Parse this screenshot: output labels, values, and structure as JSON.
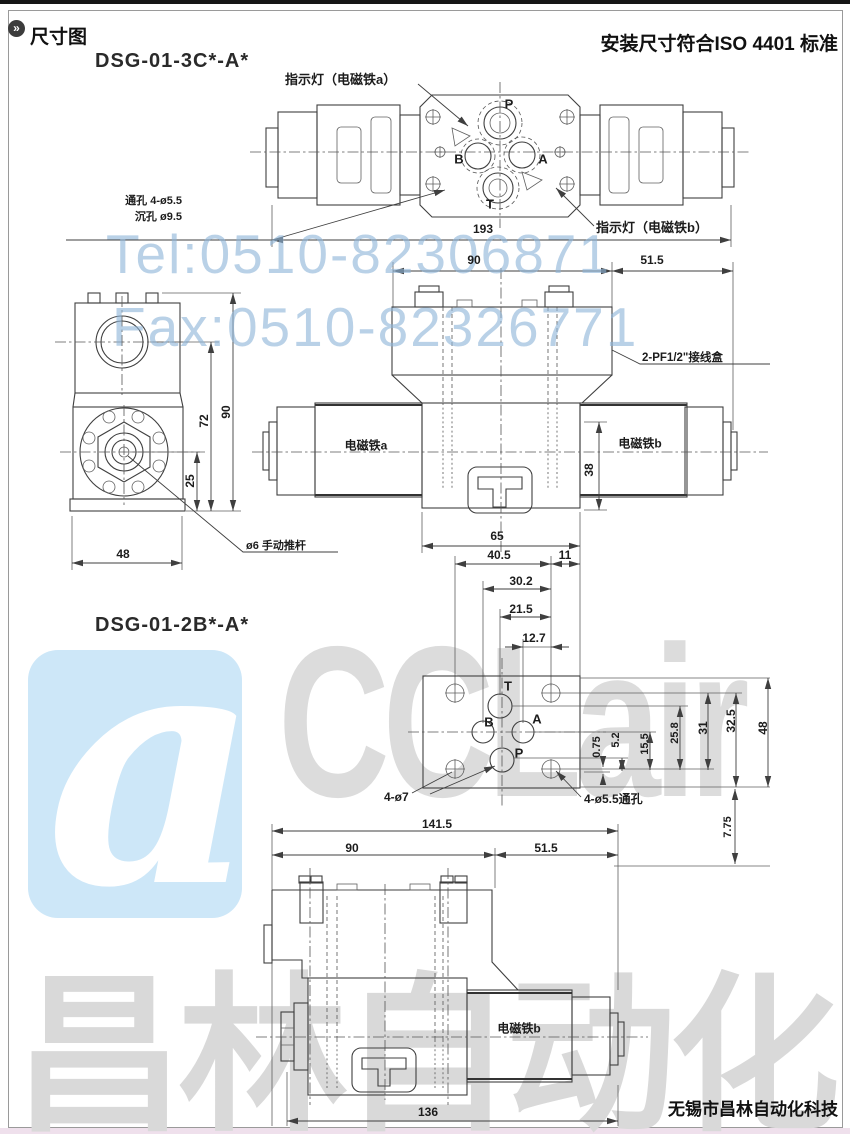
{
  "header": {
    "section_title": "尺寸图",
    "standard_note": "安装尺寸符合ISO 4401 标准",
    "bullet_glyph": "»"
  },
  "watermarks": {
    "tel": "Tel:0510-82306871",
    "fax": "Fax:0510-82326771",
    "brand_latin": "CCLair",
    "brand_cn": "昌林自动化",
    "logo_glyph": "a",
    "accent_blue": "#cde7f8",
    "text_blue": "#8eb4d8",
    "gray": "#dcdcdc"
  },
  "drawing_3c": {
    "title": "DSG-01-3C*-A*",
    "labels": {
      "indicator_a": "指示灯（电磁铁a）",
      "indicator_b": "指示灯（电磁铁b）",
      "through_hole": "通孔  4-ø5.5",
      "counterbore": "沉孔  ø9.5",
      "junction_box": "2-PF1/2\"接线盒",
      "solenoid_a": "电磁铁a",
      "solenoid_b": "电磁铁b",
      "manual_pin": "ø6  手动推杆"
    },
    "ports": {
      "p": "P",
      "b": "B",
      "a": "A",
      "t": "T"
    },
    "dims": {
      "total": "193",
      "left": "90",
      "right": "51.5",
      "height38": "38",
      "body65": "65",
      "w40_5": "40.5",
      "w11": "11",
      "side90": "90",
      "side72": "72",
      "side25": "25",
      "side48": "48"
    }
  },
  "drawing_2b": {
    "title": "DSG-01-2B*-A*",
    "labels": {
      "corner_holes": "4-ø7",
      "through_holes": "4-ø5.5通孔",
      "solenoid_b": "电磁铁b"
    },
    "ports": {
      "t": "T",
      "b": "B",
      "a": "A",
      "p": "P"
    },
    "dims": {
      "d30_2": "30.2",
      "d21_5": "21.5",
      "d12_7": "12.7",
      "d0_75": "0.75",
      "d5_2": "5.2",
      "d15_5": "15.5",
      "d25_8": "25.8",
      "d31": "31",
      "d32_5": "32.5",
      "d48": "48",
      "d7_75": "7.75",
      "d141_5": "141.5",
      "d90": "90",
      "d51_5": "51.5",
      "d136": "136"
    }
  },
  "footer": {
    "company": "无锡市昌林自动化科技"
  }
}
